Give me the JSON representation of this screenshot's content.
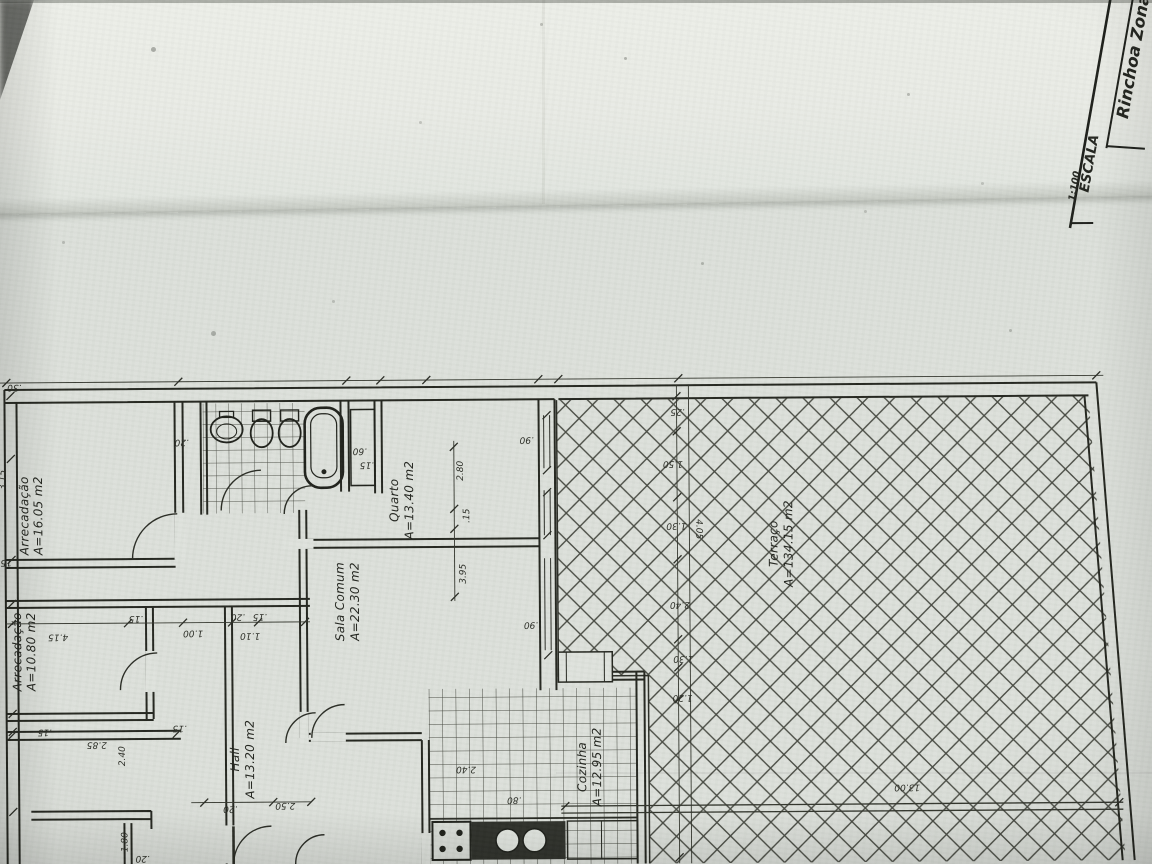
{
  "colors": {
    "paper": "#dce0da",
    "paper_light": "#e9ebe5",
    "ink": "#24261f",
    "hatch": "#383a32"
  },
  "title_block": {
    "location": "Rinchoa Zona",
    "scale_label": "ESCALA",
    "scale_value": "1:100"
  },
  "rooms": [
    {
      "name": "Arrecadação",
      "area": "A=16.05 m2"
    },
    {
      "name": "Arrecadação",
      "area": "A=10.80 m2"
    },
    {
      "name": "Hall",
      "area": "A=13.20 m2"
    },
    {
      "name": "Sala Comum",
      "area": "A=22.30 m2"
    },
    {
      "name": "Quarto",
      "area": "A=13.40 m2"
    },
    {
      "name": "Cozinha",
      "area": "A=12.95 m2"
    },
    {
      "name": "Terraço",
      "area": "A=134.15 m2"
    }
  ],
  "dimensions": [
    {
      "text": ".30"
    },
    {
      "text": ".20"
    },
    {
      "text": ".60"
    },
    {
      "text": ".15"
    },
    {
      "text": "3.15"
    },
    {
      "text": ".15"
    },
    {
      "text": "4.15"
    },
    {
      "text": ".15"
    },
    {
      "text": "1.00"
    },
    {
      "text": ".20"
    },
    {
      "text": ".15"
    },
    {
      "text": "1.10"
    },
    {
      "text": ".15"
    },
    {
      "text": "2.85"
    },
    {
      "text": ".15"
    },
    {
      "text": "2.40"
    },
    {
      "text": "1.80"
    },
    {
      "text": ".20"
    },
    {
      "text": "2.80"
    },
    {
      "text": ".15"
    },
    {
      "text": "3.95"
    },
    {
      "text": ".90"
    },
    {
      "text": ".90"
    },
    {
      "text": ".25"
    },
    {
      "text": "1.50"
    },
    {
      "text": "1.30"
    },
    {
      "text": "4.05"
    },
    {
      "text": "2.40"
    },
    {
      "text": "1.30"
    },
    {
      "text": "1.20"
    },
    {
      "text": "13.00"
    },
    {
      "text": "2.40"
    },
    {
      "text": ".80"
    },
    {
      "text": "2.50"
    },
    {
      "text": ".20"
    }
  ]
}
